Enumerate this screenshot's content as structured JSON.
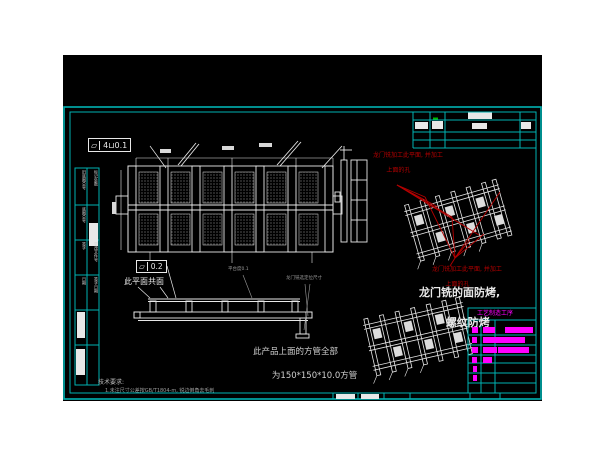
{
  "colors": {
    "frame_cyan": "#00b2b2",
    "line_white": "#e8e8e8",
    "annotation_red": "#b40000",
    "table_magenta": "#ff00ff",
    "dim_gray": "#9b9b9b",
    "background": "#000000"
  },
  "fcf": {
    "top_symbol": "⏥",
    "top_value": "4⊔0.1",
    "mid_symbol": "⏥",
    "mid_value": "0.2"
  },
  "annotations": {
    "coplanar_note": "此平面共面",
    "platform_note": "平台度0.1",
    "gantry_dim_note": "龙门铣选定位尺寸",
    "red_note_top_line1": "龙门铣加工此平面, 并加工",
    "red_note_top_line2": "上面的孔",
    "red_note_bottom_line1": "龙门铣加工此平面, 并加工",
    "red_note_bottom_line2": "上面的孔",
    "face_note_line1": "龙门铣的面防烤,",
    "face_note_line2": "螺纹防烤",
    "tube_note_line1": "此产品上面的方管全部",
    "tube_note_line2": "为150*150*10.0方管",
    "tech_title": "技术要求:",
    "tech_line1": "1.未注尺寸公差按GB/T1804-m, 锐边倒角去毛刺"
  },
  "parts_table": {
    "header": "工艺制造工序",
    "rows": [
      {
        "y": 327,
        "segments": [
          {
            "x": 472,
            "w": 6
          },
          {
            "x": 483,
            "w": 12
          },
          {
            "x": 505,
            "w": 28
          }
        ]
      },
      {
        "y": 337,
        "segments": [
          {
            "x": 472,
            "w": 5
          },
          {
            "x": 483,
            "w": 42
          }
        ]
      },
      {
        "y": 347,
        "segments": [
          {
            "x": 472,
            "w": 6
          },
          {
            "x": 483,
            "w": 14
          },
          {
            "x": 498,
            "w": 31
          }
        ]
      },
      {
        "y": 357,
        "segments": [
          {
            "x": 472,
            "w": 5
          },
          {
            "x": 483,
            "w": 9
          }
        ]
      },
      {
        "y": 366,
        "segments": [
          {
            "x": 473,
            "w": 4
          }
        ]
      },
      {
        "y": 375,
        "segments": [
          {
            "x": 473,
            "w": 4
          }
        ]
      }
    ]
  },
  "left_strip": {
    "cells": [
      {
        "x": 76,
        "y": 170,
        "w": 10,
        "h": 33,
        "text": "旧底图总号",
        "block": false
      },
      {
        "x": 76,
        "y": 207,
        "w": 10,
        "h": 31,
        "text": "底图总号",
        "block": false
      },
      {
        "x": 76,
        "y": 242,
        "w": 10,
        "h": 31,
        "text": "签字",
        "block": false
      },
      {
        "x": 76,
        "y": 277,
        "w": 10,
        "h": 31,
        "text": "日期",
        "block": false
      },
      {
        "x": 77,
        "y": 312,
        "w": 8,
        "h": 26,
        "text": "",
        "block": true
      },
      {
        "x": 76,
        "y": 349,
        "w": 9,
        "h": 26,
        "text": "",
        "block": true
      },
      {
        "x": 89,
        "y": 170,
        "w": 9,
        "h": 33,
        "text": "标记处数",
        "block": false
      },
      {
        "x": 89,
        "y": 223,
        "w": 9,
        "h": 23,
        "text": "",
        "block": true
      },
      {
        "x": 89,
        "y": 242,
        "w": 9,
        "h": 31,
        "text": "更改文件号",
        "block": false
      },
      {
        "x": 89,
        "y": 277,
        "w": 9,
        "h": 31,
        "text": "签字日期",
        "block": false
      }
    ]
  }
}
